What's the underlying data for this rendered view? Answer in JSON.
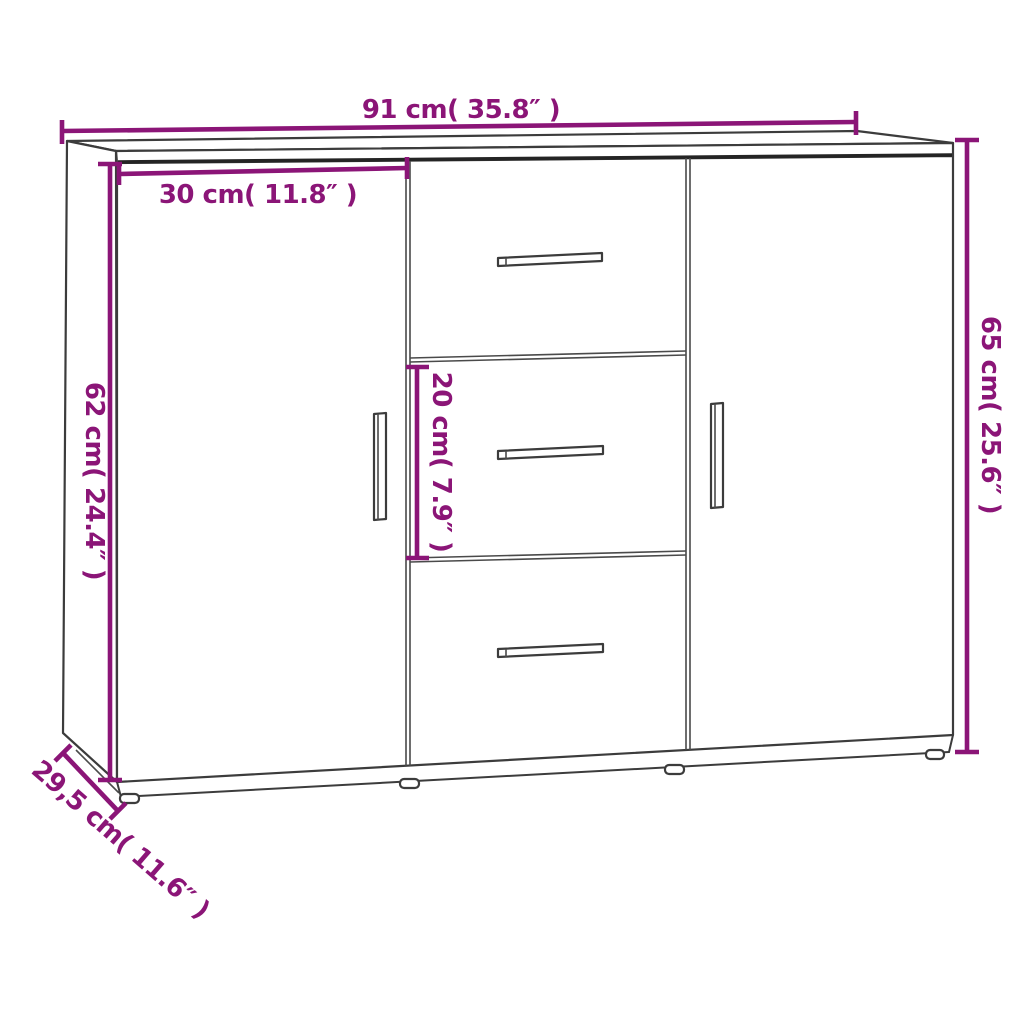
{
  "diagram": {
    "product": "sideboard-with-2-doors-3-drawers",
    "style": {
      "accent_color": "#8b1577",
      "line_color": "#3c3c3c",
      "background": "#ffffff"
    },
    "labels": {
      "width_total": "91 cm( 35.8″ )",
      "door_width": "30 cm( 11.8″ )",
      "door_height": "62 cm( 24.4″ )",
      "height_total": "65 cm( 25.6″ )",
      "drawer_height": "20 cm( 7.9″ )",
      "depth": "29,5 cm( 11.6″ )"
    }
  }
}
